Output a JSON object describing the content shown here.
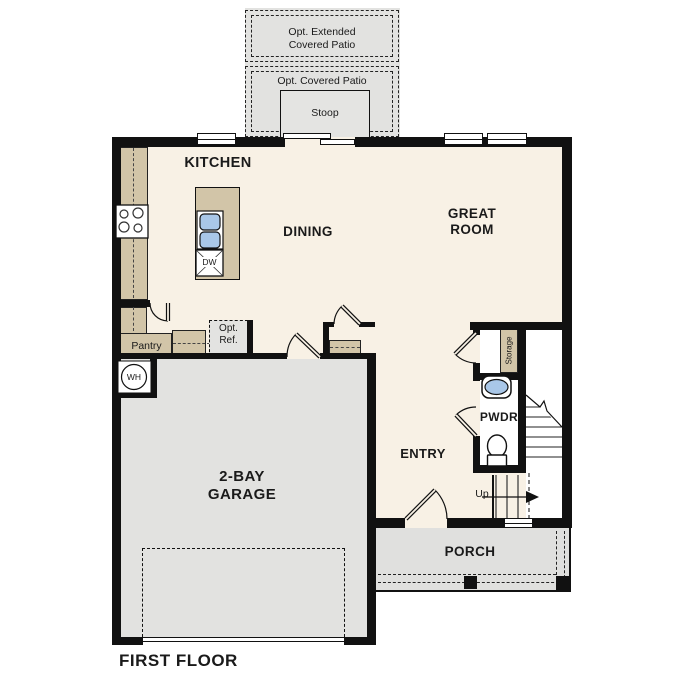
{
  "plan_title": "FIRST FLOOR",
  "colors": {
    "wall": "#111111",
    "floor": "#f8f1e5",
    "concrete": "#e2e2e0",
    "counter": "#d2c5a8",
    "water": "#a9c7e8"
  },
  "rooms": {
    "kitchen": "KITCHEN",
    "dining": "DINING",
    "great_room": "GREAT\nROOM",
    "entry": "ENTRY",
    "powder": "PWDR",
    "garage": "2-BAY\nGARAGE",
    "porch": "PORCH",
    "pantry": "Pantry",
    "storage": "Storage"
  },
  "outdoor": {
    "extended_patio": "Opt. Extended\nCovered Patio",
    "covered_patio": "Opt. Covered Patio",
    "stoop": "Stoop"
  },
  "fixtures": {
    "dishwasher": "DW",
    "water_heater": "WH",
    "optional_refrigerator": "Opt.\nRef.",
    "stairs_direction": "Up"
  }
}
